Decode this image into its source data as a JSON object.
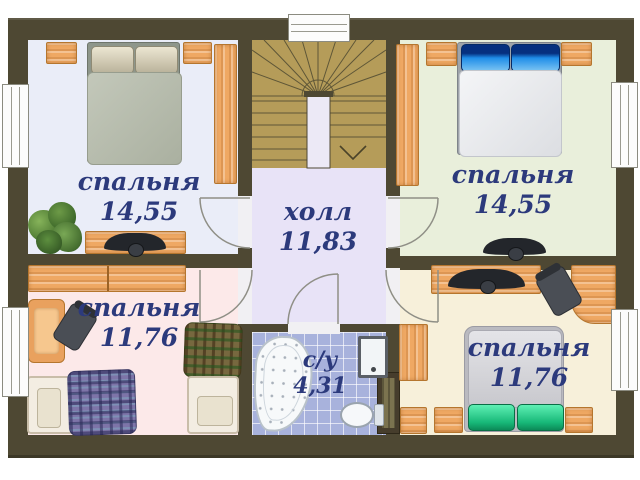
{
  "plan": {
    "type": "apartment-floor-plan",
    "language": "ru",
    "rooms": [
      {
        "key": "bedroom-top-left",
        "label": "спальня",
        "area": "14,55",
        "furniture": [
          "double-bed",
          "nightstand",
          "nightstand",
          "wardrobe",
          "plant",
          "desk-with-tv"
        ]
      },
      {
        "key": "bedroom-top-right",
        "label": "спальня",
        "area": "14,55",
        "furniture": [
          "double-bed",
          "nightstand",
          "nightstand",
          "wardrobe",
          "tv"
        ]
      },
      {
        "key": "bedroom-bottom-left",
        "label": "спальня",
        "area": "11,76",
        "furniture": [
          "wall-shelf",
          "armchair",
          "office-chair",
          "single-bed-purple-plaid",
          "single-bed-green-plaid"
        ]
      },
      {
        "key": "bedroom-bottom-right",
        "label": "спальня",
        "area": "11,76",
        "furniture": [
          "double-bed",
          "nightstand",
          "nightstand",
          "wardrobe",
          "cabinet",
          "desk",
          "office-chair",
          "shelf-with-tv"
        ]
      },
      {
        "key": "hall",
        "label": "холл",
        "area": "11,83",
        "furniture": []
      },
      {
        "key": "bathroom",
        "label": "с/у",
        "area": "4,31",
        "furniture": [
          "corner-bathtub",
          "sink",
          "toilet"
        ]
      }
    ],
    "stairs": {
      "type": "u-shaped-with-winders",
      "direction_arrow": "down"
    },
    "windows_count": 5,
    "colors": {
      "wall": "#4e4833",
      "floor_bedroom_top_left": "#eaedf8",
      "floor_bedroom_top_right": "#e9efdb",
      "floor_bedroom_bottom_left": "#fce9e9",
      "floor_bedroom_bottom_right": "#f7f0da",
      "floor_hall": "#e8e3f7",
      "floor_bathroom": "#a8b2dc",
      "stairs": "#b59c59",
      "label_text": "#2c3a7c",
      "furniture_wood": "#efa863"
    }
  }
}
